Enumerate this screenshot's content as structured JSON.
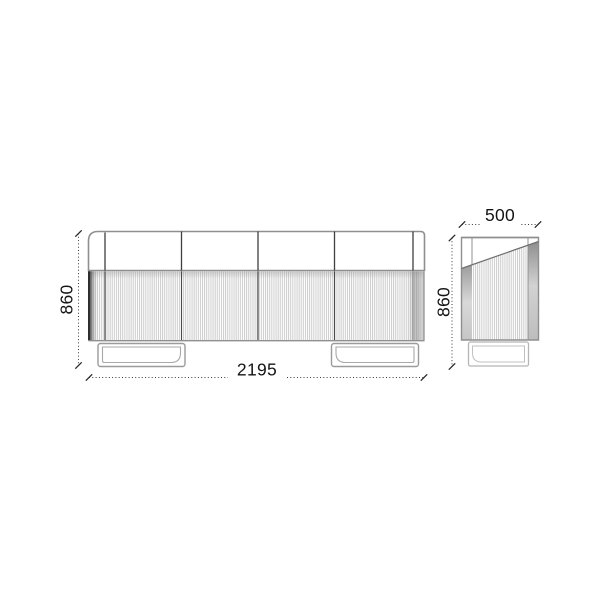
{
  "diagram": {
    "labels": {
      "front_height": "860",
      "front_width": "2195",
      "side_depth": "500",
      "side_height": "860"
    },
    "colors": {
      "background": "#ffffff",
      "outline_gray": "#8f8f8f",
      "divider_dark": "#3f3f3f",
      "flute_stripe": "#c6c6c6",
      "dimension_line": "#3a3a3a",
      "label_text": "#141414"
    }
  }
}
